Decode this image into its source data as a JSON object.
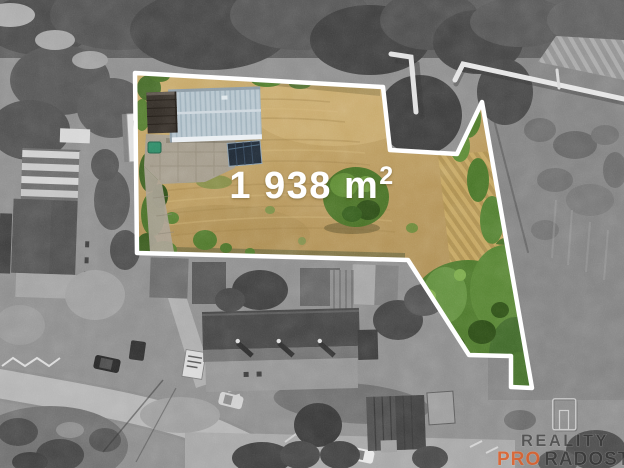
{
  "plot": {
    "area_label": "1 938 m",
    "area_superscript": "2",
    "outline_points": "135,73 383,87 390,150 457,154 482,102 532,388 511,387 511,356 469,355 408,260 137,253",
    "outline_color": "#ffffff",
    "label_color": "#ffffff"
  },
  "watermark": {
    "line1": "REALITY",
    "line2_accent": "PRO",
    "line2_rest": "RADOST",
    "accent_color": "#e2591e",
    "dark_color": "#2a2a2a"
  },
  "palette": {
    "field_tan": "#bb9c5f",
    "grass_green": "#4e7a2c",
    "roof_blue_gray": "#b6c5ce",
    "photo_gray_base": "#8f8f8f"
  }
}
